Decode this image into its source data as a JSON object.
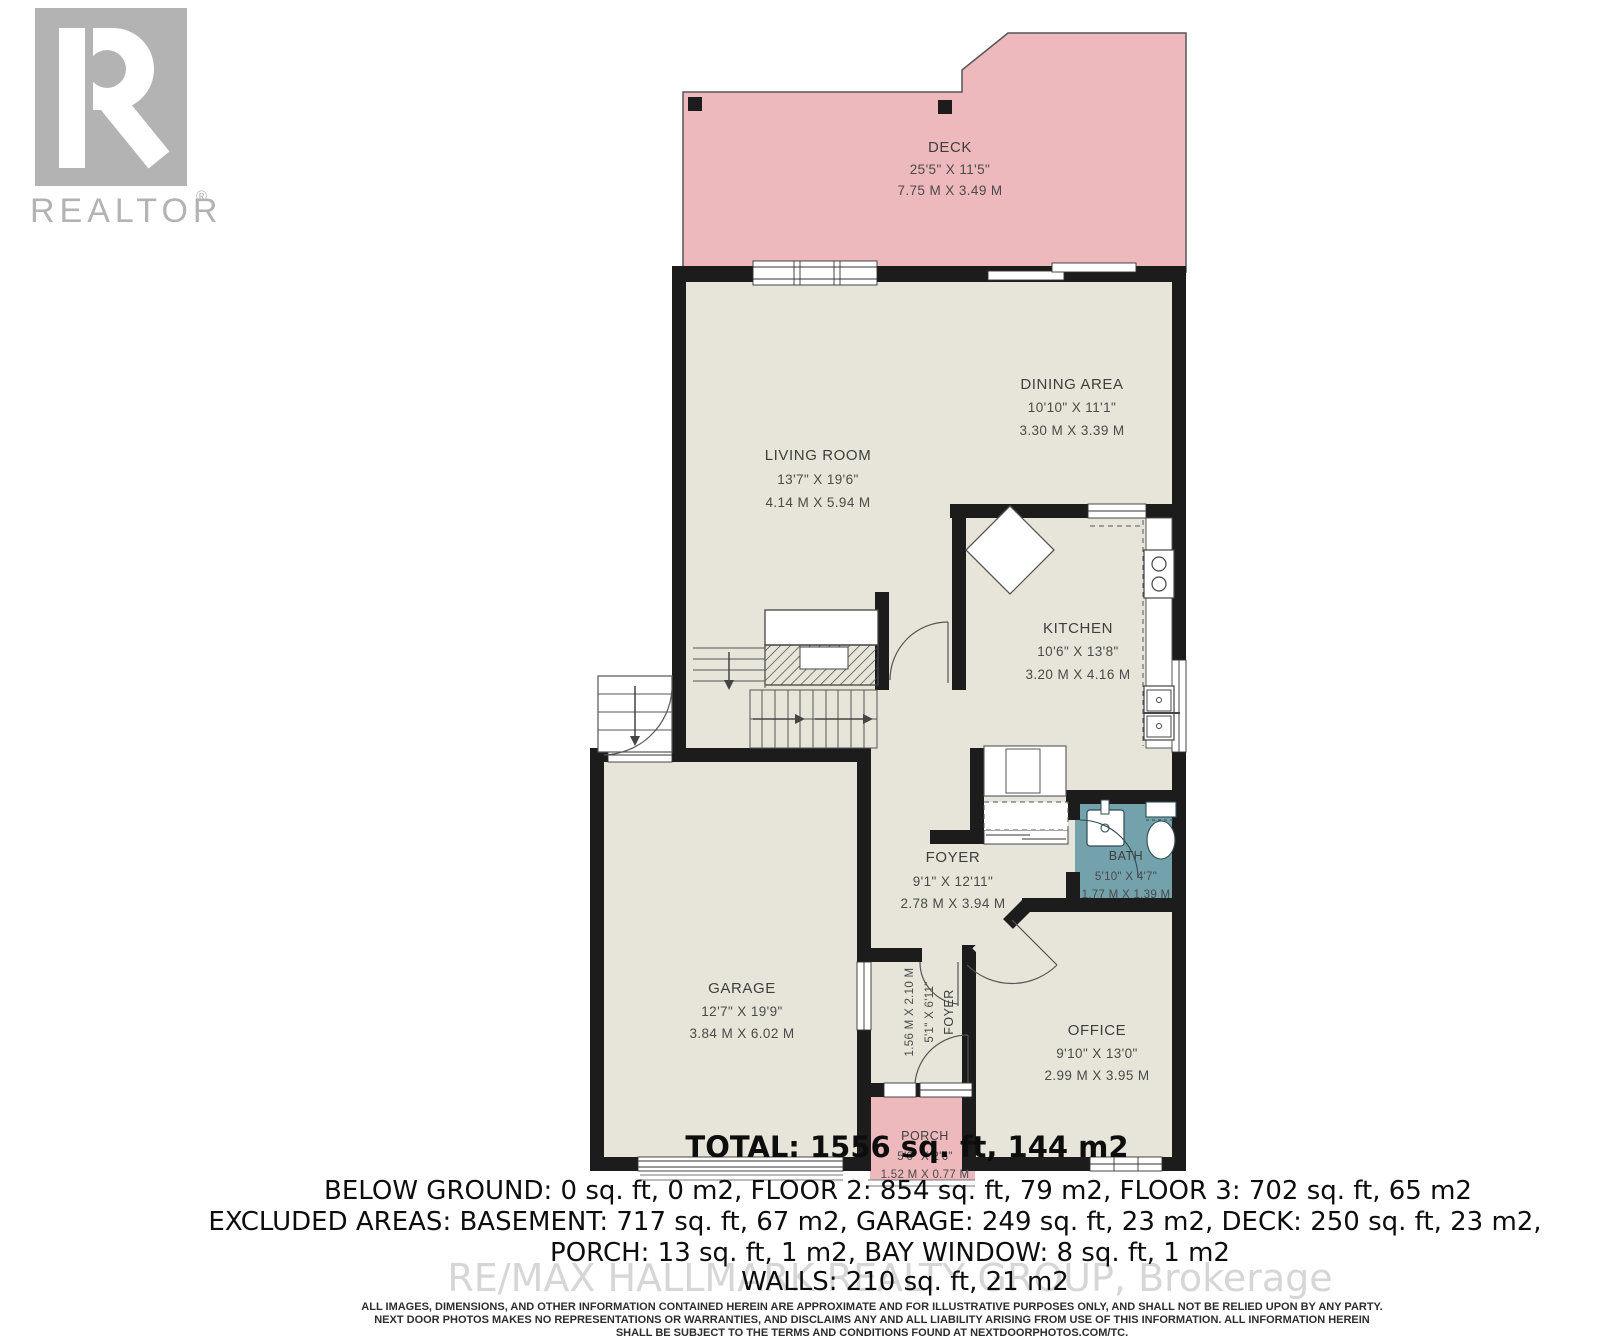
{
  "branding": {
    "realtor_logo_text": "REALTOR",
    "registered_mark": "®"
  },
  "rooms": {
    "deck": {
      "label": "DECK",
      "imperial": "25'5\" X 11'5\"",
      "metric": "7.75 M X 3.49 M"
    },
    "living": {
      "label": "LIVING ROOM",
      "imperial": "13'7\" X 19'6\"",
      "metric": "4.14 M X 5.94 M"
    },
    "dining": {
      "label": "DINING AREA",
      "imperial": "10'10\" X 11'1\"",
      "metric": "3.30 M X 3.39 M"
    },
    "kitchen": {
      "label": "KITCHEN",
      "imperial": "10'6\" X 13'8\"",
      "metric": "3.20 M X 4.16 M"
    },
    "foyer": {
      "label": "FOYER",
      "imperial": "9'1\" X 12'11\"",
      "metric": "2.78 M X 3.94 M"
    },
    "bath": {
      "label": "BATH",
      "imperial": "5'10\" X 4'7\"",
      "metric": "1.77 M X 1.39 M"
    },
    "garage": {
      "label": "GARAGE",
      "imperial": "12'7\" X 19'9\"",
      "metric": "3.84 M X 6.02 M"
    },
    "office": {
      "label": "OFFICE",
      "imperial": "9'10\" X 13'0\"",
      "metric": "2.99 M X 3.95 M"
    },
    "foyer2": {
      "label": "FOYER",
      "imperial": "5'1\" X 6'11\"",
      "metric": "1.56 M X 2.10 M"
    },
    "porch": {
      "label": "PORCH",
      "imperial": "5'0\" X 2'6\"",
      "metric": "1.52 M X 0.77 M"
    }
  },
  "summary": {
    "total": "TOTAL: 1556 sq. ft, 144 m2",
    "floors": "BELOW GROUND: 0 sq. ft, 0 m2, FLOOR 2: 854 sq. ft, 79 m2, FLOOR 3: 702 sq. ft, 65 m2",
    "excluded": "EXCLUDED AREAS: BASEMENT: 717 sq. ft, 67 m2, GARAGE: 249 sq. ft, 23 m2, DECK: 250 sq. ft, 23 m2,",
    "excluded2": "PORCH: 13 sq. ft, 1 m2, BAY WINDOW: 8 sq. ft, 1 m2",
    "walls": "WALLS: 210 sq. ft, 21 m2"
  },
  "watermark": "RE/MAX HALLMARK REALTY GROUP, Brokerage",
  "disclaimer": {
    "l1": "ALL IMAGES, DIMENSIONS, AND OTHER INFORMATION CONTAINED HEREIN ARE APPROXIMATE AND FOR ILLUSTRATIVE PURPOSES ONLY, AND SHALL NOT BE RELIED UPON BY ANY PARTY.",
    "l2": "NEXT DOOR PHOTOS MAKES NO REPRESENTATIONS OR WARRANTIES, AND DISCLAIMS ANY AND ALL LIABILITY ARISING FROM USE OF THIS INFORMATION. ALL INFORMATION HEREIN",
    "l3": "SHALL BE SUBJECT TO THE TERMS AND CONDITIONS FOUND AT NEXTDOORPHOTOS.COM/TC."
  },
  "colors": {
    "deck_pink": "#edb9bd",
    "floor_beige": "#e7e5d9",
    "bath_teal": "#74a2ac",
    "wall_black": "#1c1c1c",
    "logo_gray": "#b3b3b3",
    "watermark_gray": "#cdcdcd"
  }
}
